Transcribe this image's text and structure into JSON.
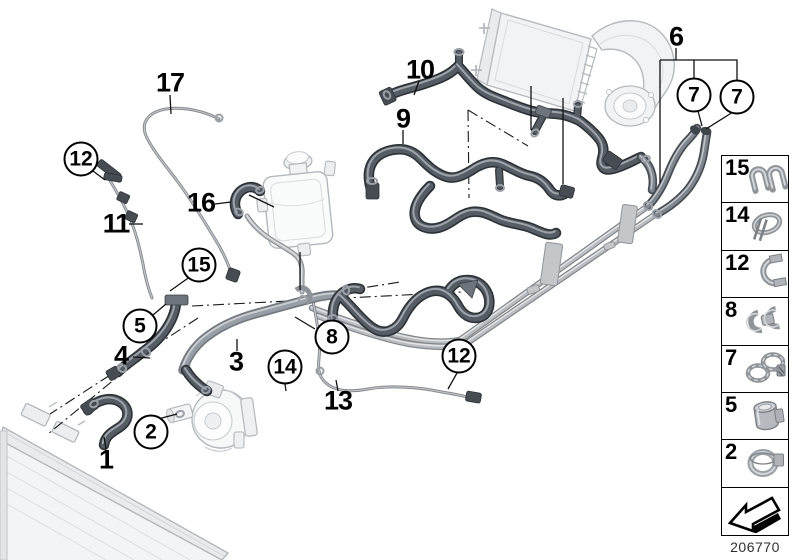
{
  "figure": {
    "part_number": "206770"
  },
  "callouts": {
    "plain": [
      {
        "label": "17",
        "x": 170,
        "y": 83
      },
      {
        "label": "11",
        "x": 116,
        "y": 224
      },
      {
        "label": "16",
        "x": 201,
        "y": 203
      },
      {
        "label": "10",
        "x": 420,
        "y": 70
      },
      {
        "label": "9",
        "x": 403,
        "y": 119
      },
      {
        "label": "6",
        "x": 676,
        "y": 37
      },
      {
        "label": "4",
        "x": 121,
        "y": 356
      },
      {
        "label": "3",
        "x": 236,
        "y": 362
      },
      {
        "label": "1",
        "x": 106,
        "y": 460
      },
      {
        "label": "13",
        "x": 338,
        "y": 401
      }
    ],
    "circled": [
      {
        "label": "12",
        "x": 81,
        "y": 159
      },
      {
        "label": "15",
        "x": 199,
        "y": 265
      },
      {
        "label": "5",
        "x": 140,
        "y": 326
      },
      {
        "label": "2",
        "x": 151,
        "y": 432
      },
      {
        "label": "14",
        "x": 285,
        "y": 367
      },
      {
        "label": "8",
        "x": 332,
        "y": 337
      },
      {
        "label": "12",
        "x": 459,
        "y": 356
      },
      {
        "label": "7",
        "x": 694,
        "y": 95
      },
      {
        "label": "7",
        "x": 737,
        "y": 97
      }
    ]
  },
  "legend": {
    "items": [
      {
        "label": "15",
        "icon": "double-line-clip-icon"
      },
      {
        "label": "14",
        "icon": "spring-band-clamp-icon"
      },
      {
        "label": "12",
        "icon": "pipe-holder-clip-icon"
      },
      {
        "label": "8",
        "icon": "double-hose-clip-icon"
      },
      {
        "label": "7",
        "icon": "hose-clamp-pair-icon"
      },
      {
        "label": "5",
        "icon": "sleeve-clamp-icon"
      },
      {
        "label": "2",
        "icon": "ring-clamp-icon"
      }
    ],
    "footer_icon": "direction-of-travel-arrow-icon"
  }
}
